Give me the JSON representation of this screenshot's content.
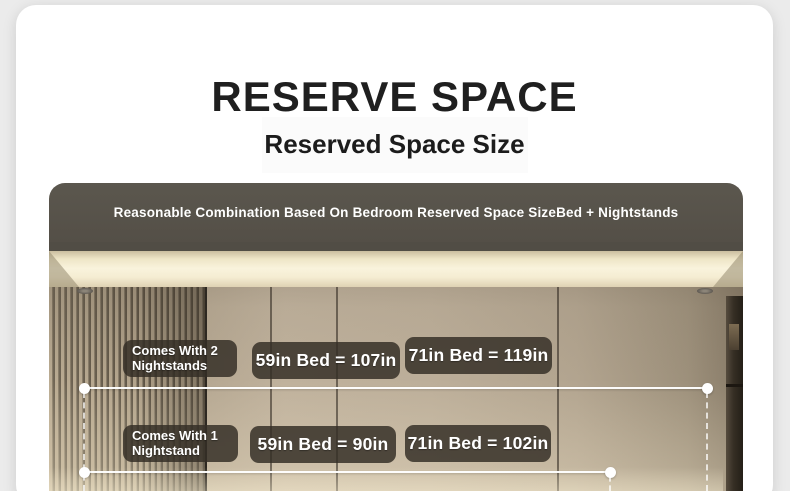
{
  "page": {
    "title": "RESERVE SPACE",
    "subtitle": "Reserved Space Size"
  },
  "banner": {
    "text": "Reasonable Combination Based On Bedroom Reserved Space SizeBed + Nightstands"
  },
  "diagram": {
    "rows": [
      {
        "tag": [
          "Comes With 2",
          "Nightstands"
        ],
        "measurements": [
          "59in Bed = 107in",
          "71in Bed = 119in"
        ]
      },
      {
        "tag": [
          "Comes With 1",
          "Nightstand"
        ],
        "measurements": [
          "59in Bed = 90in",
          "71in Bed = 102in"
        ]
      }
    ]
  },
  "colors": {
    "page_background": "#ebebeb",
    "card_background": "#ffffff",
    "title_text": "#1f1f1f",
    "banner_background": "#544f47",
    "banner_text": "#ffffff",
    "label_background": "#342f26",
    "label_text": "#ffffff",
    "dimension_line": "#ffffff",
    "ceiling_glow": "#f9f3dc",
    "wall_tone": "#bcae99"
  }
}
